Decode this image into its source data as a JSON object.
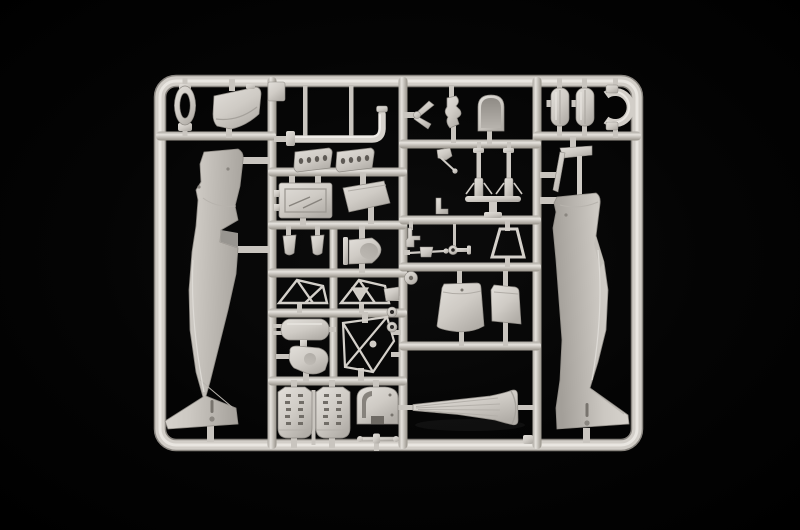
{
  "scene": {
    "description": "Product photograph of a light grey injection-molded plastic model kit sprue (parts tree) for a propeller aircraft kit, shot on a black background",
    "background_color": "#000000",
    "plastic_color": "#d4d0ca",
    "plastic_highlight": "#eae7e2",
    "plastic_shadow": "#a19d97",
    "detail_dark": "#5e5a55",
    "frame_shape": "rounded rectangle sprue frame with internal runner grid"
  },
  "parts": {
    "canopy_ring": {
      "label": "oval ring part"
    },
    "cowl_panel": {
      "label": "cowling panel part"
    },
    "left_fuselage": {
      "label": "left fuselage half"
    },
    "exhaust_pipe": {
      "label": "curved exhaust pipe part"
    },
    "exhaust_shrouds": {
      "label": "two perforated exhaust shroud parts"
    },
    "radiator_box": {
      "label": "radiator box part"
    },
    "sloped_panel": {
      "label": "slanted access panel part"
    },
    "seat_buckets": {
      "label": "two small bucket parts"
    },
    "cooler_fairing": {
      "label": "round-nosed cooler fairing part"
    },
    "engine_bearers": {
      "label": "two triangular engine bearer frames"
    },
    "oil_tank": {
      "label": "cylindrical oil tank part"
    },
    "supercharger": {
      "label": "supercharger blob part"
    },
    "engine_mount": {
      "label": "engine mount truss frame"
    },
    "engine_blocks": {
      "label": "two engine block halves"
    },
    "firewall": {
      "label": "arched firewall bulkhead part"
    },
    "linkage_rod": {
      "label": "small linkage rod part"
    },
    "control_cross": {
      "label": "small cross-shaped control part"
    },
    "fuselage_former": {
      "label": "wavy fuselage former part"
    },
    "headrest_door": {
      "label": "round-topped headrest door part"
    },
    "gear_legs": {
      "label": "landing gear leg assembly"
    },
    "gear_bracket": {
      "label": "small gear bracket and pin"
    },
    "gear_lever": {
      "label": "small lever part"
    },
    "pitot_rod": {
      "label": "pitot rod part"
    },
    "key_link": {
      "label": "eyelet link part"
    },
    "windscreen_frame": {
      "label": "trapezoid windscreen frame part"
    },
    "tail_wheel": {
      "label": "small tail wheel disc"
    },
    "gear_doors": {
      "label": "two landing gear door panels"
    },
    "eyelet_rings": {
      "label": "small eyelet ring parts"
    },
    "wing_fairing": {
      "label": "long flared wing-root fairing part"
    },
    "fuel_tanks": {
      "label": "two pill-shaped tank parts"
    },
    "clamp_ring": {
      "label": "C-shaped clamp ring part"
    },
    "right_fuselage": {
      "label": "right fuselage half with windscreen frame"
    },
    "small_plate": {
      "label": "small square plate part"
    }
  }
}
